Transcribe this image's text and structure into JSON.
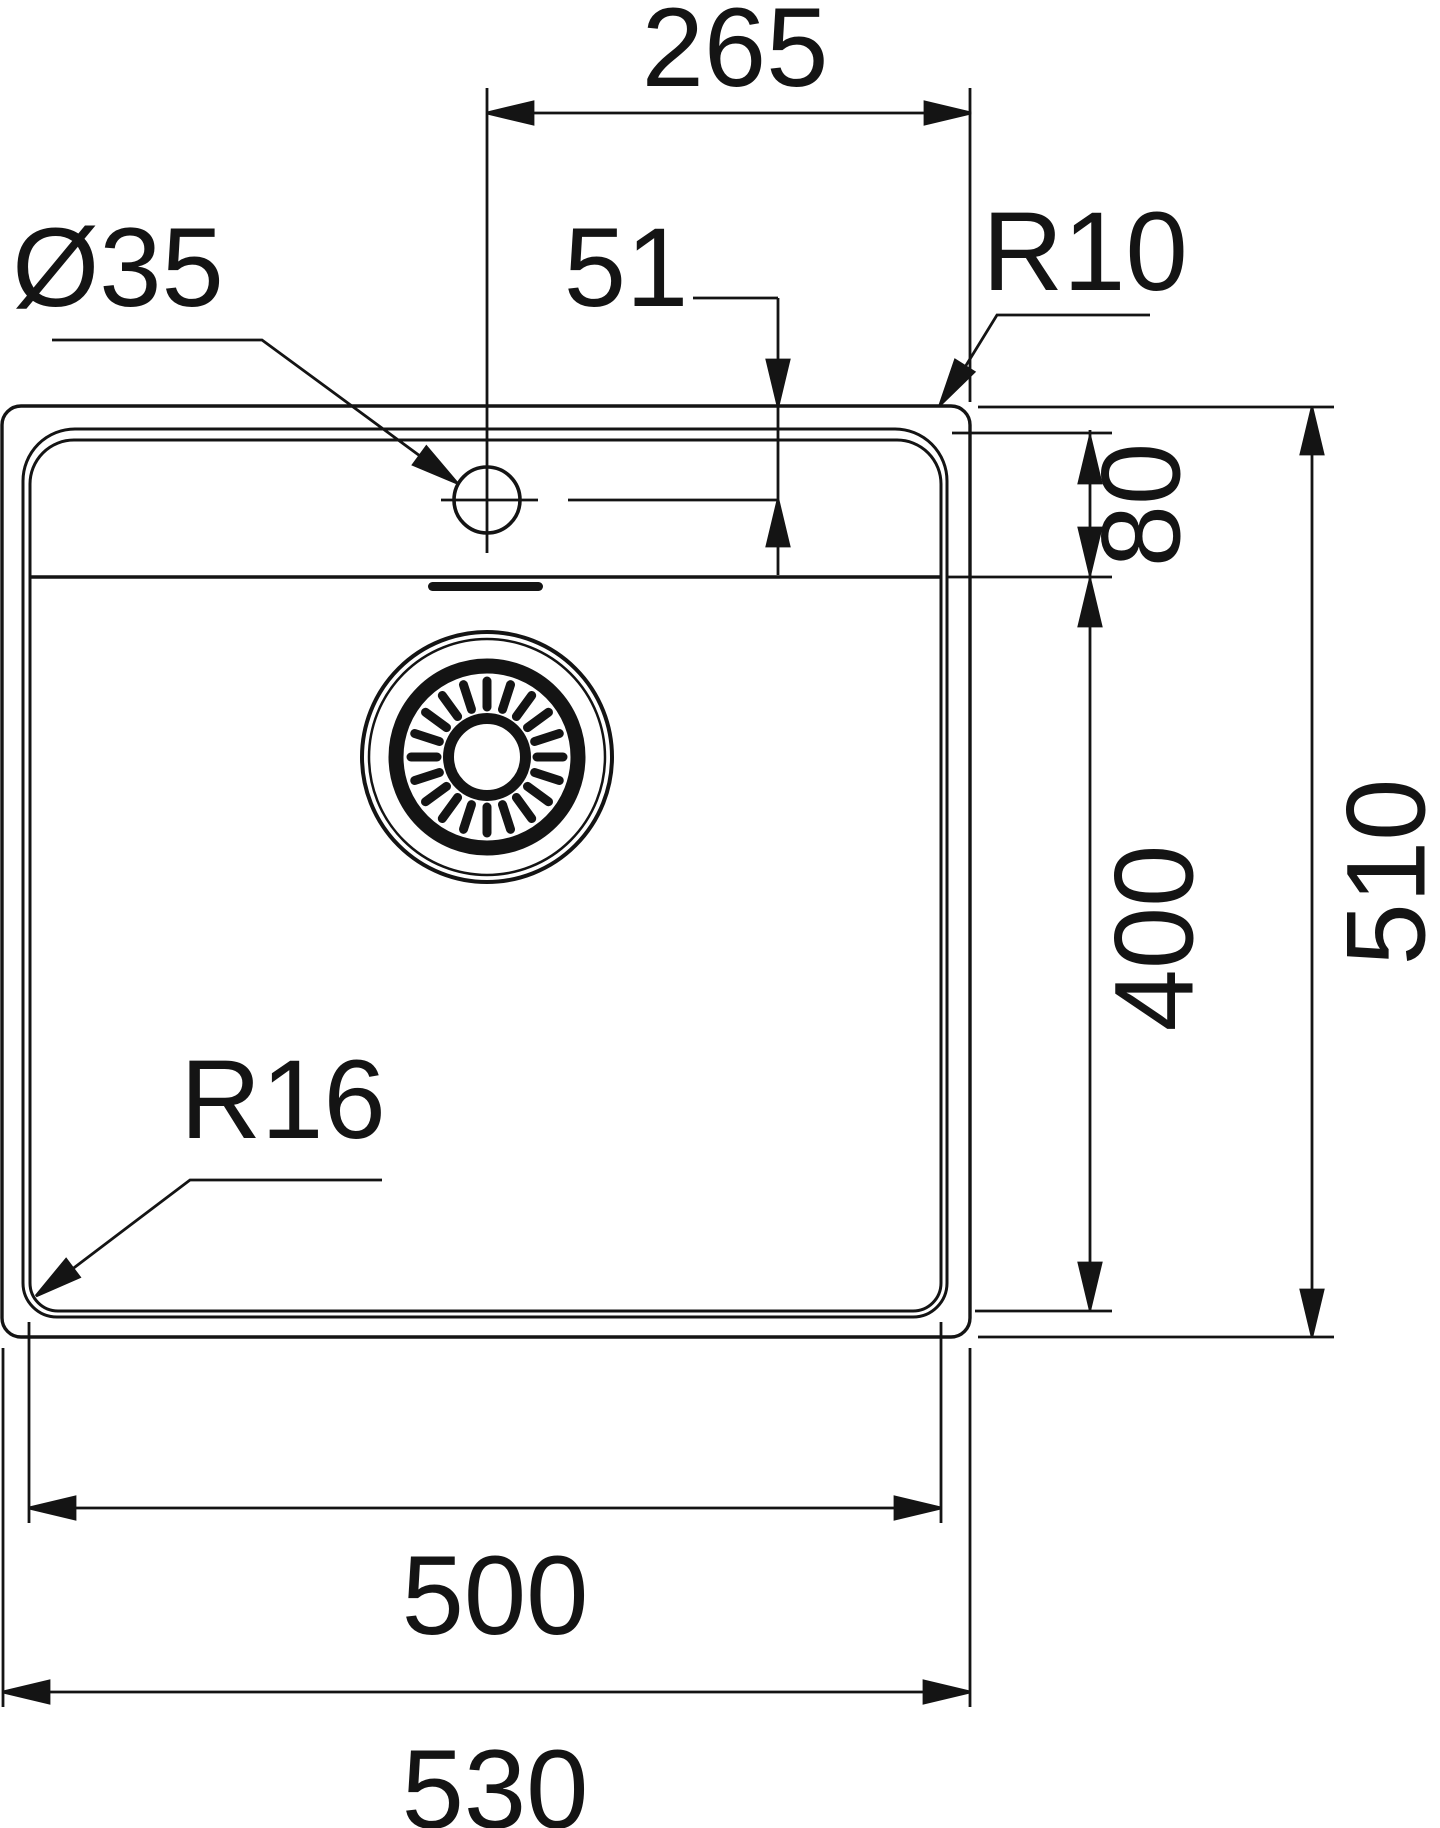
{
  "drawing": {
    "title": "sink-plan-technical-drawing",
    "line_color": "#141414",
    "background": "#ffffff",
    "labels": {
      "d265": "265",
      "d51": "51",
      "dia35": "Ø35",
      "r10": "R10",
      "d80": "80",
      "d400": "400",
      "d510": "510",
      "r16": "R16",
      "d500": "500",
      "d530": "530"
    }
  }
}
